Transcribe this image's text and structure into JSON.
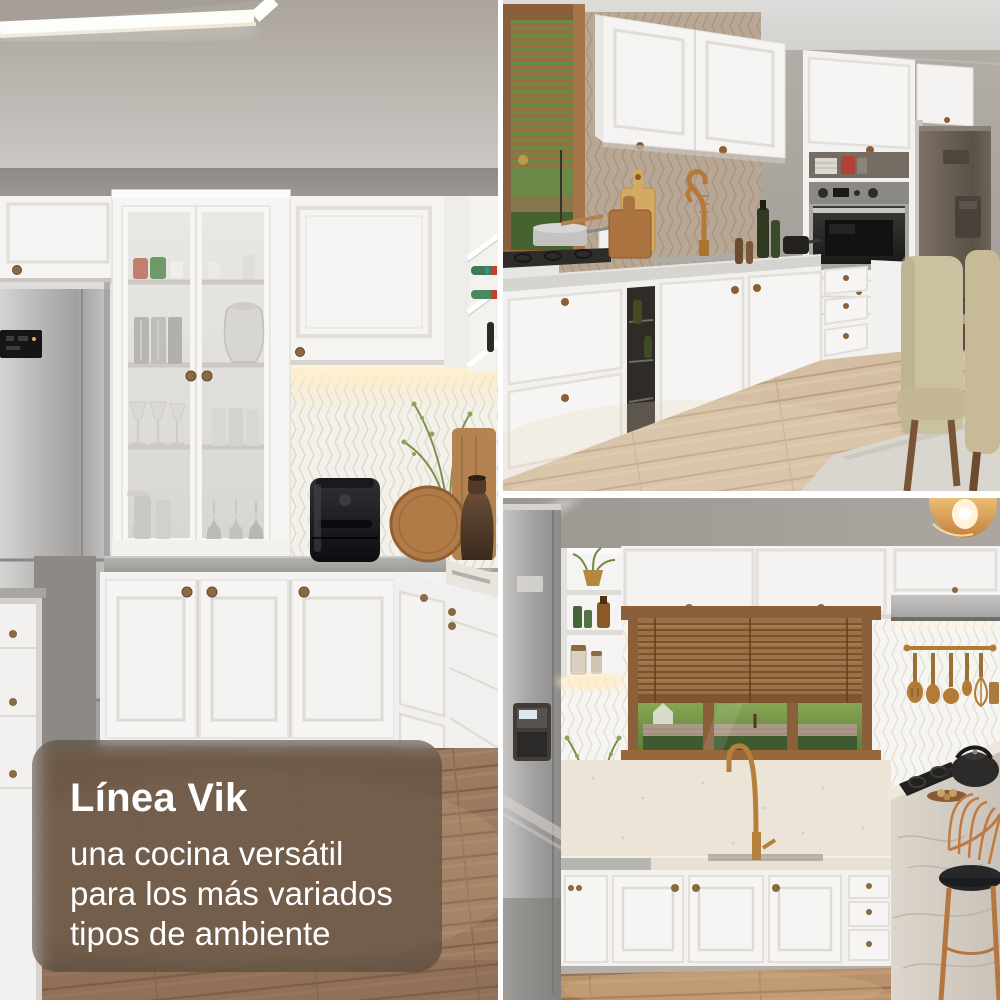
{
  "overlay": {
    "title": "Línea Vik",
    "lines": [
      "una cocina versátil",
      "para los más variados",
      "tipos de ambiente"
    ]
  },
  "panels": {
    "left": {
      "label": "cocina blanca con vitrina de cristal, heladera de acero y freidora de aire"
    },
    "top_right": {
      "label": "cocina blanca con ventana, horno empotrado, heladera y sillas de comedor"
    },
    "bottom_right": {
      "label": "cocina blanca con cortina de madera, grifería dorada e isla de mármol"
    }
  },
  "colors": {
    "frame_white": "#ffffff",
    "cabinet_white": "#f4f3f1",
    "brass_hardware": "#8a6a42",
    "gold_fixture": "#b5803c",
    "overlay_background": "rgba(66,57,50,0.5)",
    "overlay_text": "#ffffff",
    "wood_floor": "#9a785f"
  }
}
